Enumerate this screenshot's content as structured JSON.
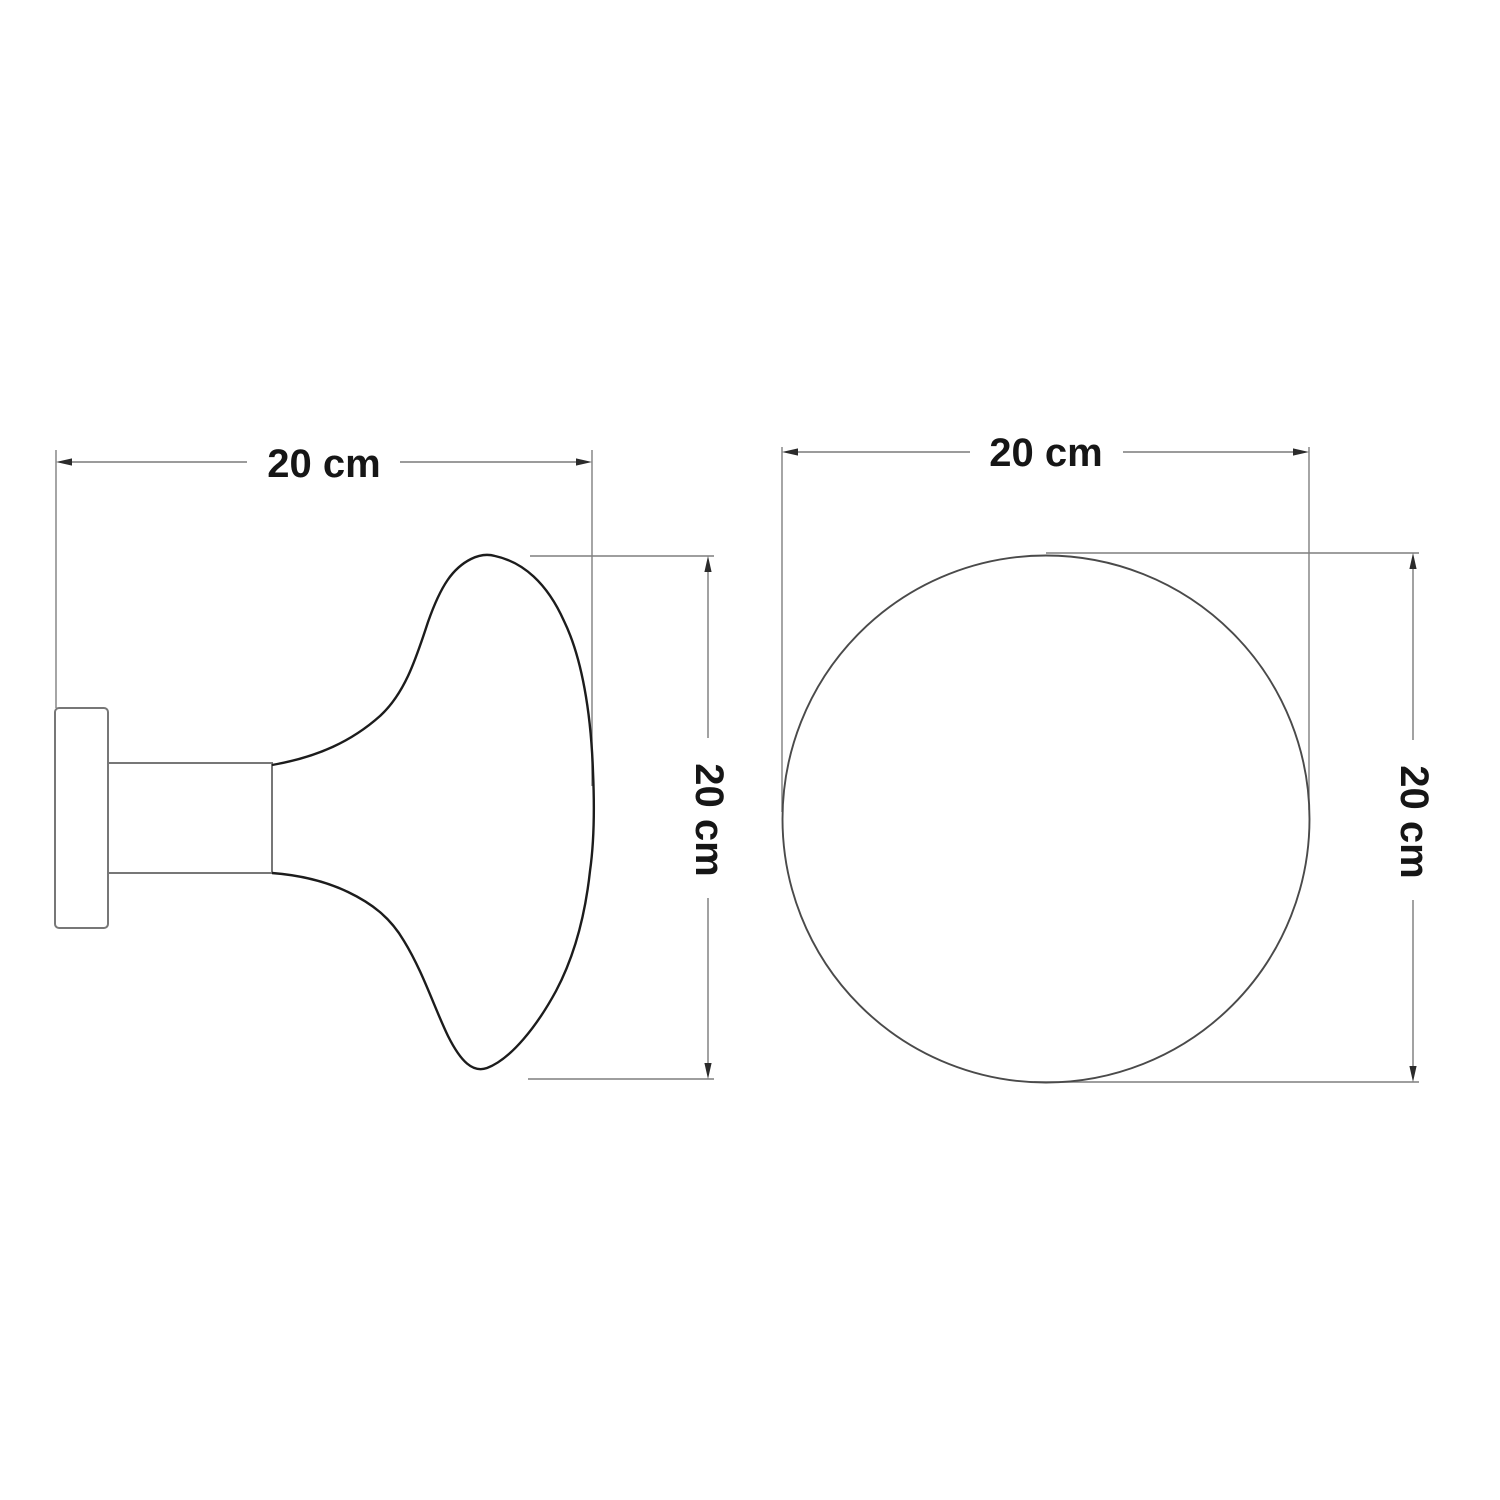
{
  "drawing": {
    "background_color": "#ffffff",
    "dimension_line_color": "#7a7a7a",
    "outline_color": "#1c1c1c",
    "hardware_line_color": "#777777",
    "circle_line_color": "#4a4a4a",
    "text_color": "#161616",
    "unit": "cm",
    "side_view": {
      "width_value": 20,
      "height_value": 20,
      "width_label": "20 cm",
      "height_label": "20 cm"
    },
    "front_view": {
      "width_value": 20,
      "height_value": 20,
      "width_label": "20 cm",
      "height_label": "20 cm"
    }
  }
}
